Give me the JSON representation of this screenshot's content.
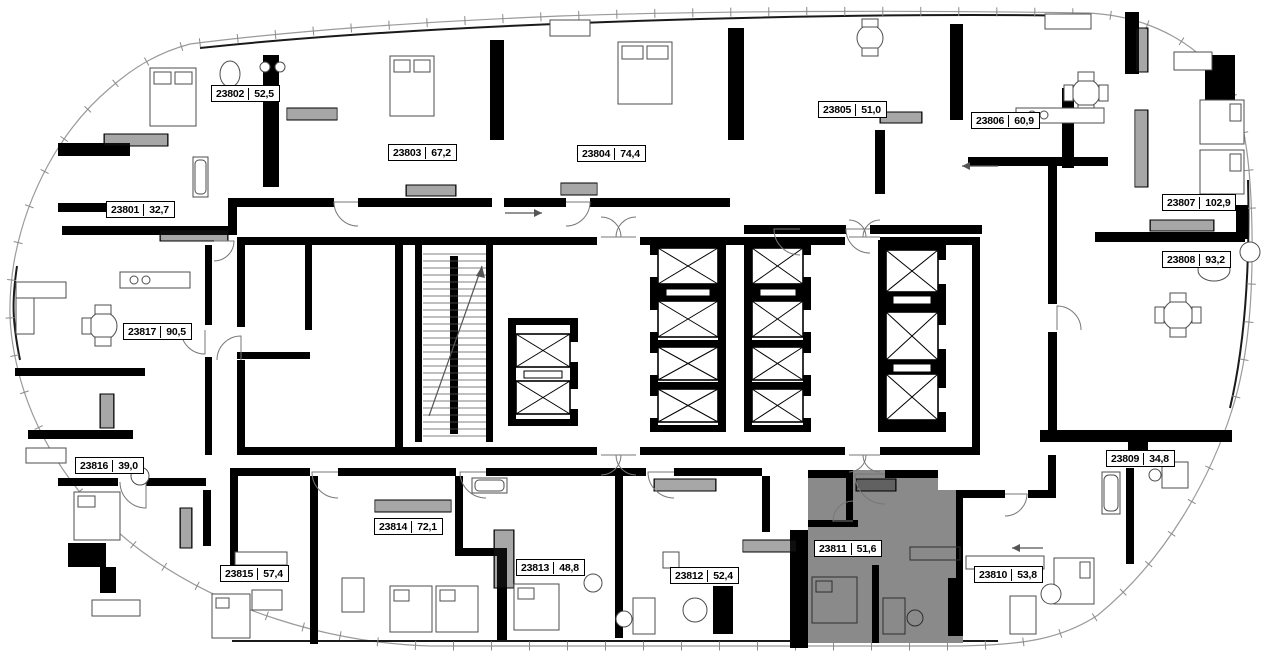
{
  "plan": {
    "type": "residential-floor-plan",
    "highlight_color": "#8a8a8a",
    "wall_color": "#000000",
    "outline_color": "#9a9a9a",
    "highlighted_apartment": "23811",
    "apartments": [
      {
        "id": "23801",
        "area": "32,7",
        "x": 106,
        "y": 201,
        "highlighted": false
      },
      {
        "id": "23802",
        "area": "52,5",
        "x": 211,
        "y": 85,
        "highlighted": false
      },
      {
        "id": "23803",
        "area": "67,2",
        "x": 388,
        "y": 144,
        "highlighted": false
      },
      {
        "id": "23804",
        "area": "74,4",
        "x": 577,
        "y": 145,
        "highlighted": false
      },
      {
        "id": "23805",
        "area": "51,0",
        "x": 818,
        "y": 101,
        "highlighted": false
      },
      {
        "id": "23806",
        "area": "60,9",
        "x": 971,
        "y": 112,
        "highlighted": false
      },
      {
        "id": "23807",
        "area": "102,9",
        "x": 1162,
        "y": 194,
        "highlighted": false
      },
      {
        "id": "23808",
        "area": "93,2",
        "x": 1162,
        "y": 251,
        "highlighted": false
      },
      {
        "id": "23809",
        "area": "34,8",
        "x": 1106,
        "y": 450,
        "highlighted": false
      },
      {
        "id": "23810",
        "area": "53,8",
        "x": 974,
        "y": 566,
        "highlighted": false
      },
      {
        "id": "23811",
        "area": "51,6",
        "x": 814,
        "y": 540,
        "highlighted": true
      },
      {
        "id": "23812",
        "area": "52,4",
        "x": 670,
        "y": 567,
        "highlighted": false
      },
      {
        "id": "23813",
        "area": "48,8",
        "x": 516,
        "y": 559,
        "highlighted": false
      },
      {
        "id": "23814",
        "area": "72,1",
        "x": 374,
        "y": 518,
        "highlighted": false
      },
      {
        "id": "23815",
        "area": "57,4",
        "x": 220,
        "y": 565,
        "highlighted": false
      },
      {
        "id": "23816",
        "area": "39,0",
        "x": 75,
        "y": 457,
        "highlighted": false
      },
      {
        "id": "23817",
        "area": "90,5",
        "x": 123,
        "y": 323,
        "highlighted": false
      }
    ]
  }
}
